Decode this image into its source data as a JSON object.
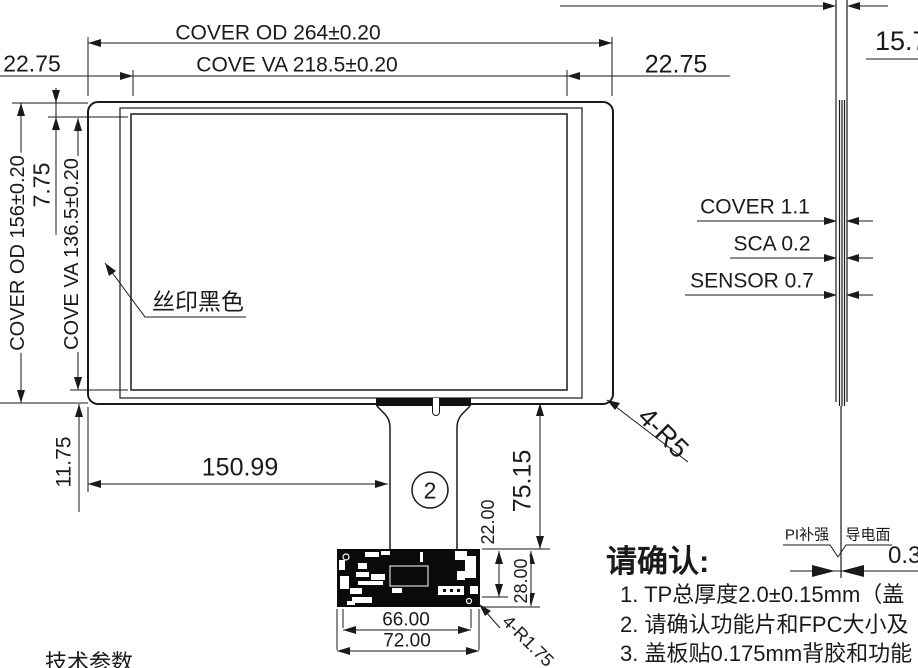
{
  "drawing": {
    "front_view": {
      "dim_cover_od_width": "COVER OD 264±0.20",
      "dim_cover_va_width": "COVE VA 218.5±0.20",
      "dim_margin_left": "22.75",
      "dim_margin_right": "22.75",
      "dim_cover_od_height": "COVER OD 156±0.20",
      "dim_cover_va_height": "COVE VA 136.5±0.20",
      "dim_top_border": "7.75",
      "dim_bottom_border": "11.75",
      "silk_print_label": "丝印黑色",
      "corner_radius_label": "4-R5",
      "dim_fpc_offset": "150.99",
      "detail_marker": "2"
    },
    "fpc": {
      "dim_tail_length": "75.15",
      "dim_board_upper": "22.00",
      "dim_board_height": "28.00",
      "dim_board_inner_width": "66.00",
      "dim_board_width": "72.00",
      "board_corner_radius_label": "4-R1.75"
    },
    "side_view": {
      "dim_edge": "15.7",
      "layer_cover": "COVER 1.1",
      "layer_sca": "SCA 0.2",
      "layer_sensor": "SENSOR 0.7",
      "label_pi_stiffener": "PI补强",
      "label_conductive_face": "导电面",
      "dim_fpc_thickness": "0.3"
    },
    "notes": {
      "title": "请确认:",
      "items": [
        "1. TP总厚度2.0±0.15mm（盖",
        "2. 请确认功能片和FPC大小及",
        "3. 盖板贴0.175mm背胶和功能"
      ]
    },
    "footer": "技术参数",
    "colors": {
      "line": "#1a1a1a",
      "background": "#ffffff"
    }
  }
}
